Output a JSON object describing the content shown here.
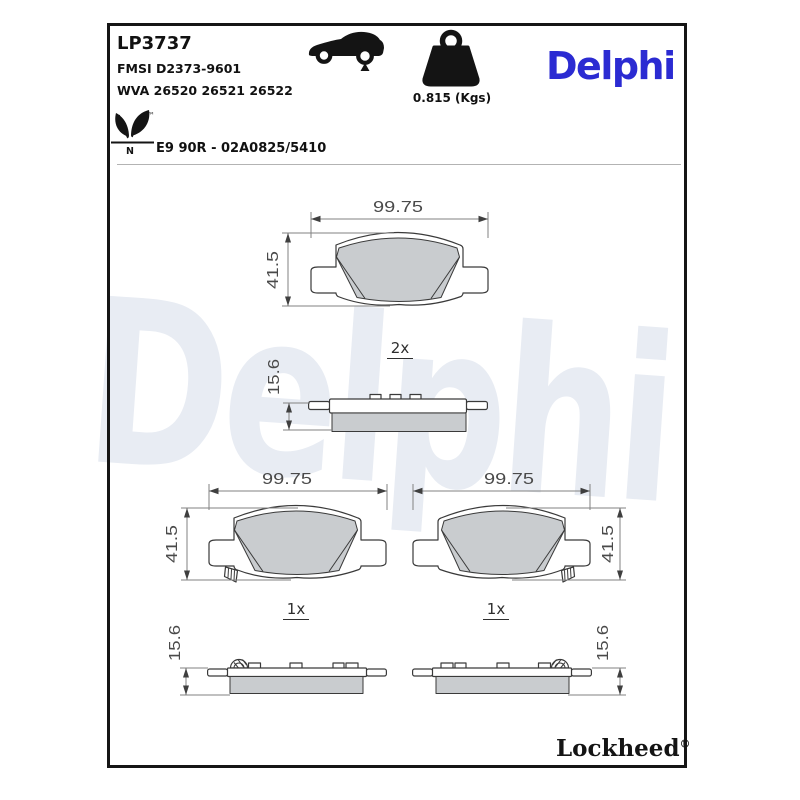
{
  "header": {
    "part_number": "LP3737",
    "fmsi": "FMSI D2373-9601",
    "wva": "WVA 26520 26521 26522",
    "homologation": "E9 90R - 02A0825/5410",
    "weight": "0.815 (Kgs)",
    "brand_logo": "Delphi",
    "leaf_trademark": "™",
    "leaf_letter": "N"
  },
  "watermark": {
    "text": "Delphi",
    "color": "#e8ecf3"
  },
  "drawings": {
    "top_pad": {
      "width": "99.75",
      "height": "41.5",
      "qty": "2x",
      "thickness": "15.6"
    },
    "bottom_left_pad": {
      "width": "99.75",
      "height": "41.5",
      "qty": "1x",
      "thickness": "15.6"
    },
    "bottom_right_pad": {
      "width": "99.75",
      "height": "41.5",
      "qty": "1x",
      "thickness": "15.6"
    }
  },
  "footer": {
    "brand": "Lockheed",
    "registered": "®"
  },
  "colors": {
    "brand_blue": "#2b2bd2",
    "friction_gray": "#c9cccf",
    "outline_dark": "#3a3a3a",
    "dimension_gray": "#4a4a4a",
    "watermark_blue": "#e8ecf3"
  }
}
